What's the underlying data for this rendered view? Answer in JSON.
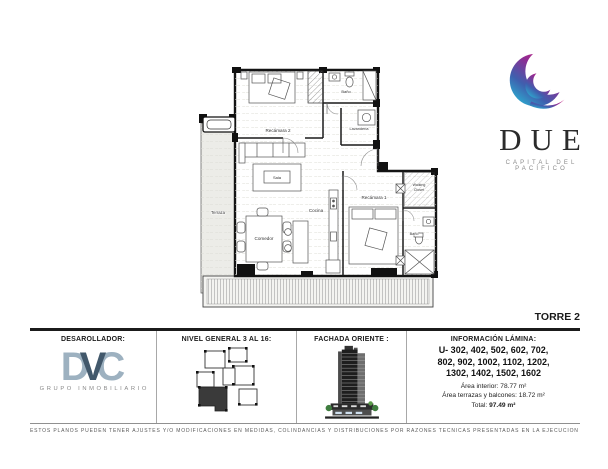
{
  "brand": {
    "name": "DUE",
    "tagline": "CAPITAL DEL PACÍFICO",
    "gradient_top": "#d4217f",
    "gradient_bottom": "#2ab5d4"
  },
  "tower_label": "TORRE 2",
  "floorplan": {
    "labels": {
      "terraza": "Terraza",
      "recamara2": "Recámara 2",
      "bano2": "Baño",
      "lavanderia": "Lavandería",
      "sala": "Sala",
      "cocina": "Cocina",
      "comedor": "Comedor",
      "recamara1": "Recámara 1",
      "walking_line1": "Walking",
      "walking_line2": "Closet",
      "bano1": "Baño"
    }
  },
  "panels": {
    "developer": {
      "title": "DESAROLLADOR:",
      "logo_d": "D",
      "logo_v": "V",
      "logo_c": "C",
      "logo_sub": "GRUPO INMOBILIARIO",
      "logo_light": "#9db1c0",
      "logo_dark": "#42586b"
    },
    "keyplan": {
      "title": "NIVEL GENERAL 3 AL 16:"
    },
    "facade": {
      "title": "FACHADA ORIENTE :"
    },
    "info": {
      "title": "INFORMACIÓN LÁMINA:",
      "units_line1": "U- 302, 402, 502, 602, 702,",
      "units_line2": "802, 902, 1002, 1102, 1202,",
      "units_line3": "1302, 1402, 1502, 1602",
      "area_interior_label": "Área interior:",
      "area_interior_value": "78.77 m²",
      "area_terrazas_label": "Área terrazas y balcones:",
      "area_terrazas_value": "18.72 m²",
      "total_label": "Total:",
      "total_value": "97.49 m²"
    }
  },
  "disclaimer": "ESTOS PLANOS PUEDEN TENER AJUSTES Y/O MODIFICACIONES EN MEDIDAS, COLINDANCIAS Y DISTRIBUCIONES POR RAZONES TÉCNICAS PRESENTADAS EN LA EJECUCIÓN DE LA OBRA."
}
